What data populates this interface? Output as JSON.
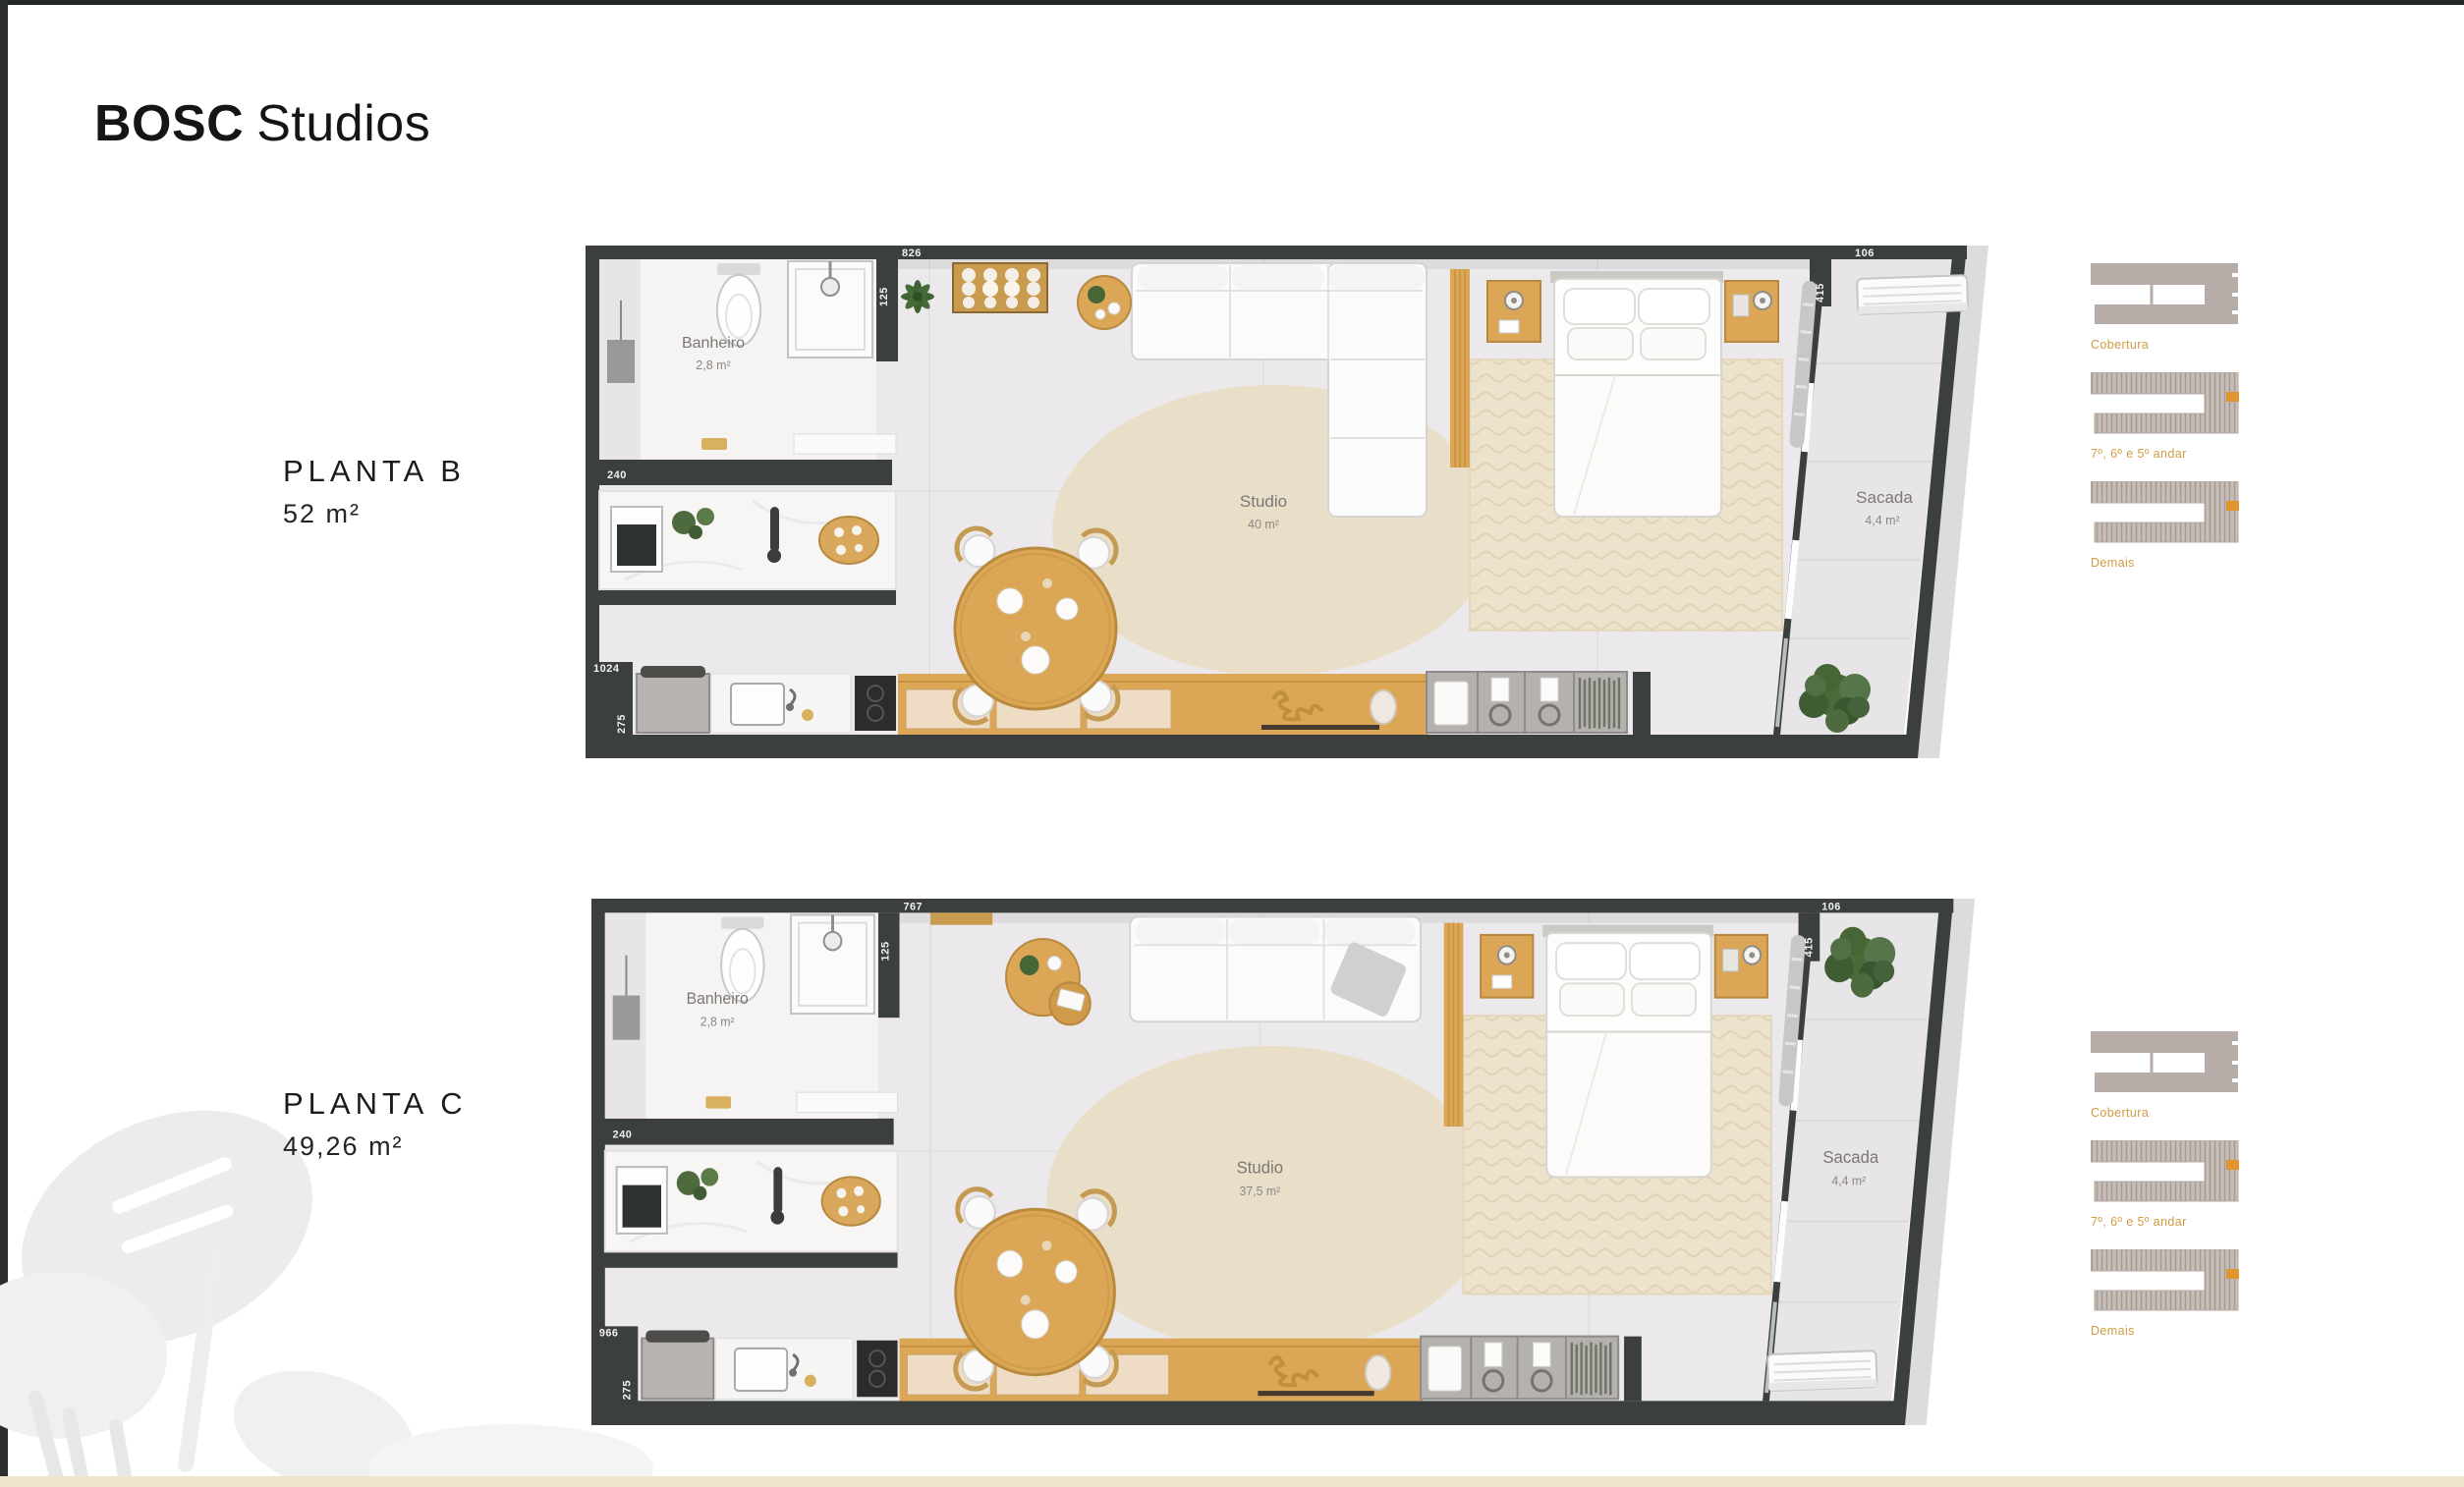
{
  "page": {
    "title_bold": "BOSC",
    "title_regular": "Studios",
    "accent_color": "#cf9c43",
    "wall_color": "#3b403f",
    "footer_strip_color": "#f2e5cd"
  },
  "plans": [
    {
      "name": "PLANTA B",
      "area": "52 m²",
      "rooms": {
        "bathroom": {
          "label": "Banheiro",
          "area": "2,8 m²"
        },
        "studio": {
          "label": "Studio",
          "area": "40 m²"
        },
        "balcony": {
          "label": "Sacada",
          "area": "4,4 m²"
        }
      },
      "dimensions": {
        "entry_wall": "240",
        "bath_wall": "125",
        "top_wall": "826",
        "kitchen_wall": "1024",
        "kitchen_depth": "275",
        "balcony_wall": "415",
        "balcony_top": "106"
      },
      "floor_key": [
        {
          "label": "Cobertura"
        },
        {
          "label": "7º, 6º e 5º andar"
        },
        {
          "label": "Demais"
        }
      ]
    },
    {
      "name": "PLANTA C",
      "area": "49,26 m²",
      "rooms": {
        "bathroom": {
          "label": "Banheiro",
          "area": "2,8 m²"
        },
        "studio": {
          "label": "Studio",
          "area": "37,5 m²"
        },
        "balcony": {
          "label": "Sacada",
          "area": "4,4 m²"
        }
      },
      "dimensions": {
        "entry_wall": "240",
        "bath_wall": "125",
        "top_wall": "767",
        "kitchen_wall": "966",
        "kitchen_depth": "275",
        "balcony_wall": "415",
        "balcony_top": "106"
      },
      "floor_key": [
        {
          "label": "Cobertura"
        },
        {
          "label": "7º, 6º e 5º andar"
        },
        {
          "label": "Demais"
        }
      ]
    }
  ]
}
